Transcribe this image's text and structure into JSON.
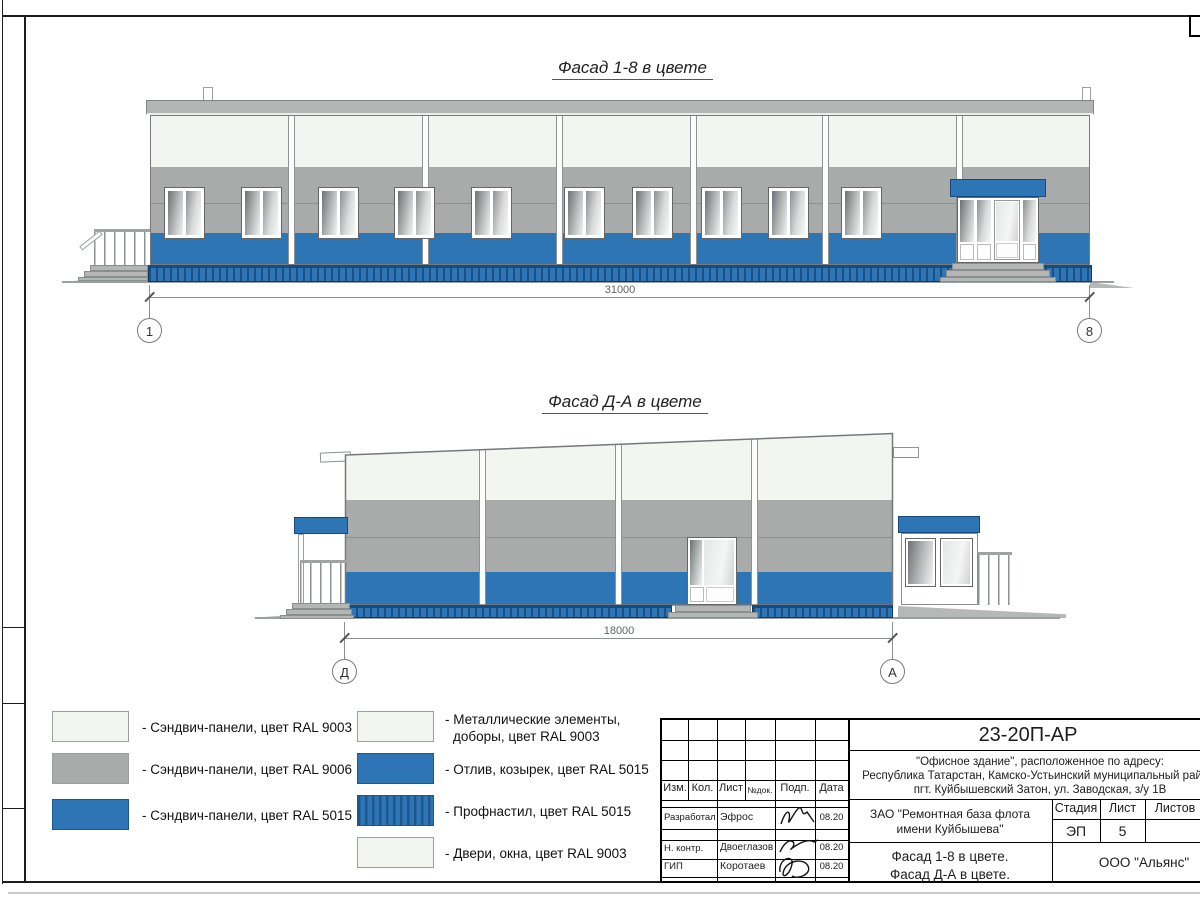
{
  "facade1": {
    "title": "Фасад 1-8 в цвете",
    "dimension": "31000",
    "axis_left": "1",
    "axis_right": "8"
  },
  "facade2": {
    "title": "Фасад Д-А в цвете",
    "dimension": "18000",
    "axis_left": "Д",
    "axis_right": "А"
  },
  "legend": {
    "col1": [
      {
        "label": "- Сэндвич-панели, цвет RAL 9003"
      },
      {
        "label": "- Сэндвич-панели, цвет RAL 9006"
      },
      {
        "label": "- Сэндвич-панели, цвет RAL 5015"
      }
    ],
    "col2": [
      {
        "label": "- Металлические элементы,",
        "label2": "доборы, цвет RAL 9003"
      },
      {
        "label": "- Отлив, козырек, цвет RAL 5015"
      },
      {
        "label": "- Профнастил, цвет RAL 5015"
      },
      {
        "label": "- Двери, окна, цвет RAL 9003"
      }
    ]
  },
  "titleblock": {
    "doc_number": "23-20П-АР",
    "project_line1": "\"Офисное здание\", расположенное по адресу:",
    "project_line2": "Республика Татарстан, Камско-Устьинский муниципальный район,",
    "project_line3": "пгт. Куйбышевский Затон, ул. Заводская, з/у 1В",
    "client_line1": "ЗАО \"Ремонтная база флота",
    "client_line2": "имени Куйбышева\"",
    "content_line1": "Фасад 1-8 в цвете.",
    "content_line2": "Фасад Д-А в цвете.",
    "company": "ООО \"Альянс\"",
    "stage_label": "Стадия",
    "sheet_label": "Лист",
    "sheets_label": "Листов",
    "stage_value": "ЭП",
    "sheet_value": "5",
    "columns": [
      "Изм.",
      "Кол.",
      "Лист",
      "№док.",
      "Подп.",
      "Дата"
    ],
    "rows": [
      {
        "role": "Разработал",
        "name": "Эфрос",
        "date": "08.20"
      },
      {
        "role": "Н. контр.",
        "name": "Двоеглазов",
        "date": "08.20"
      },
      {
        "role": "ГИП",
        "name": "Коротаев",
        "date": "08.20"
      }
    ]
  },
  "colors": {
    "ral9003": "#f3f5f0",
    "ral9006": "#a9abaa",
    "ral5015": "#2e75b6"
  }
}
